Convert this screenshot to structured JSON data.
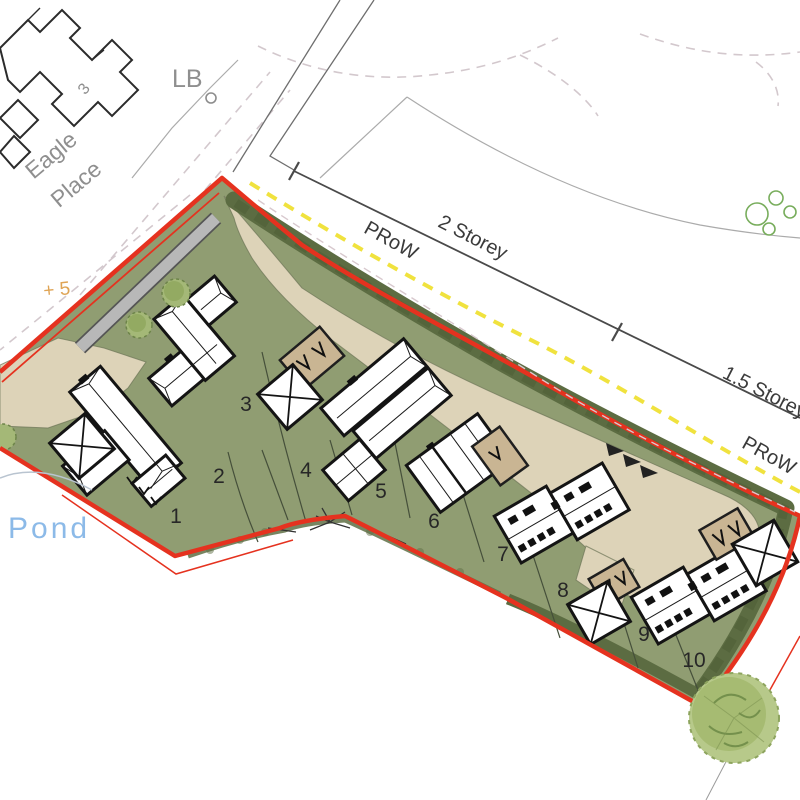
{
  "labels": {
    "street_name": "Eagle Place",
    "street_line1": "Eagle",
    "street_line2": "Place",
    "letter_box": "LB",
    "house_number_3": "3",
    "pond": "Pond",
    "prow_top": "PRoW",
    "prow_right": "PRoW",
    "storey_two": "2 Storey",
    "storey_one_half": "1.5 Storey",
    "level_mark": "+ 5"
  },
  "plots": [
    {
      "number": "1"
    },
    {
      "number": "2"
    },
    {
      "number": "3"
    },
    {
      "number": "4"
    },
    {
      "number": "5"
    },
    {
      "number": "6"
    },
    {
      "number": "7"
    },
    {
      "number": "8"
    },
    {
      "number": "9"
    },
    {
      "number": "10"
    }
  ],
  "colors": {
    "site_boundary_red": "#e5321f",
    "prow_yellow": "#f0e23e",
    "grass_green": "#909d72",
    "hedge_green": "#5c6c42",
    "driveway_tan": "#ddd3b8",
    "garage_tan": "#c9b593",
    "pond_label_blue": "#8cbae8",
    "road_dash_grey": "#d3c8cd",
    "level_mark_orange": "#dfa455"
  }
}
